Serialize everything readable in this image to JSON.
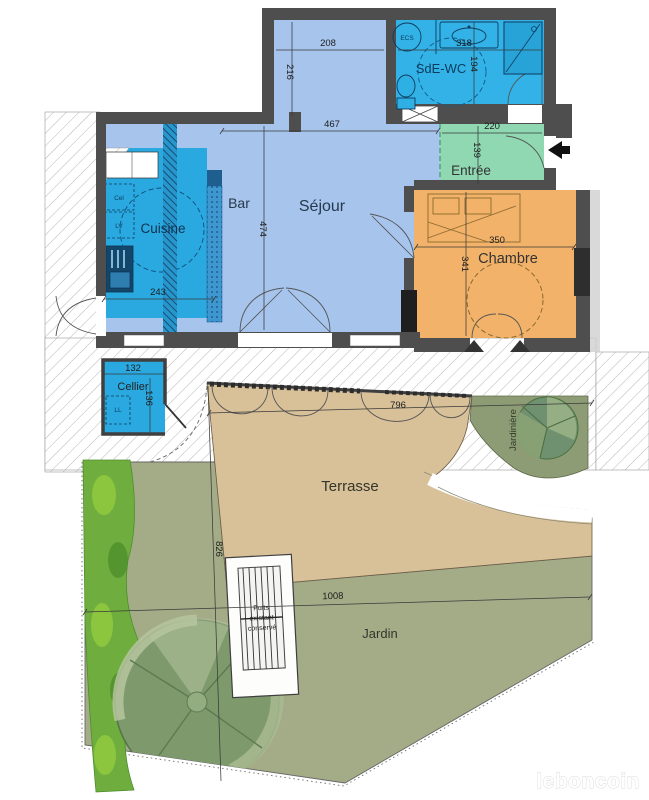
{
  "plan": {
    "watermark": "leboncoin",
    "rooms": {
      "sejour": "Séjour",
      "bar": "Bar",
      "cuisine": "Cuisine",
      "sde_wc": "SdE-WC",
      "entree": "Entrée",
      "chambre": "Chambre",
      "cellier": "Cellier",
      "terrasse": "Terrasse",
      "jardiniere": "Jardinière",
      "jardin": "Jardin"
    },
    "labels": {
      "ecs": "ECS",
      "cel": "Cel",
      "lv": "LV",
      "ll": "LL",
      "well_line1": "Puits",
      "well_line2": "existant",
      "well_line3": "conservé"
    },
    "dimensions": {
      "d208": "208",
      "d216": "216",
      "d318": "318",
      "d194": "194",
      "d467": "467",
      "d474": "474",
      "d220": "220",
      "d139": "139",
      "d350": "350",
      "d341": "341",
      "d243": "243",
      "d132": "132",
      "d136": "136",
      "d796": "796",
      "d826": "826",
      "d1008": "1008"
    },
    "colors": {
      "wall": "#4e4e4e",
      "sejour": "#a6c4ec",
      "wet": "#29a9e0",
      "sde": "#32b2e6",
      "entree": "#8fd8b2",
      "chambre": "#f2b269",
      "terrasse": "#d8c099",
      "jardiniere": "#8d9c74",
      "jardin": "#a3ab87",
      "bush": "#6fae3e",
      "tree": "#7d9a6e"
    }
  }
}
